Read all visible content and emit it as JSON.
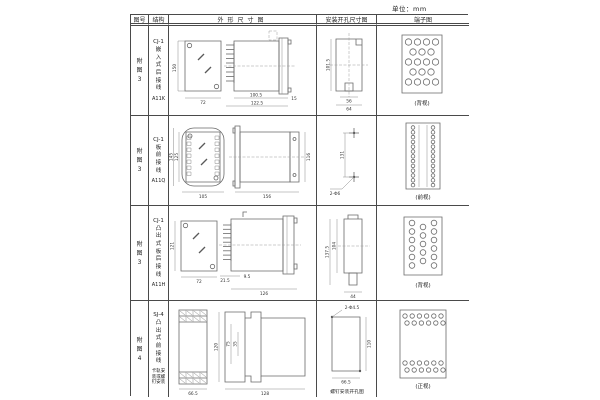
{
  "page": {
    "unit_label": "单位：mm"
  },
  "header": {
    "fig_col": "图号",
    "struct_col": "结构",
    "outline_col": "外形尺寸图",
    "mount_col": "安装开孔尺寸图",
    "terminal_col": "端子图"
  },
  "rows": [
    {
      "fig_no": "附图3",
      "model": "CJ-1",
      "structure": "嵌入式后接线",
      "code": "A11K",
      "outline": {
        "front_h": "150",
        "front_w": "72",
        "side_w1": "100.5",
        "side_w2": "122.5",
        "side_w3": "15"
      },
      "mount": {
        "v1": "101.5",
        "h1": "56",
        "h2": "64"
      },
      "terminal": {
        "view_label": "(背视)"
      }
    },
    {
      "fig_no": "附图3",
      "model": "CJ-1",
      "structure": "板前接线",
      "code": "A11Q",
      "outline": {
        "front_h1": "145",
        "front_h2": "125",
        "front_w": "105",
        "side_l": "156",
        "side_h": "116"
      },
      "mount": {
        "v1": "131",
        "hole_label": "2-Φ6"
      },
      "terminal": {
        "view_label": "(前视)"
      }
    },
    {
      "fig_no": "附图3",
      "model": "CJ-1",
      "structure": "凸出式板后接线",
      "code": "A11H",
      "outline": {
        "front_h": "121",
        "front_w": "72",
        "pin_l": "21.5",
        "gap": "9.5",
        "side_l": "126"
      },
      "mount": {
        "v1": "137.5",
        "v2": "104",
        "h1": "44"
      },
      "terminal": {
        "view_label": "(背视)"
      }
    },
    {
      "fig_no": "附图4",
      "model": "SJ-4",
      "structure": "凸出式前接线",
      "note": "卡轨安装或螺钉安装",
      "outline": {
        "front_w": "66.5",
        "side_h": "120",
        "d1": "75",
        "d2": "35",
        "side_l": "128"
      },
      "mount": {
        "hole_label": "2-Φ4.5",
        "v1": "110",
        "h1": "66.5",
        "caption": "螺钉安装开孔图"
      },
      "terminal": {
        "view_label": "(正视)"
      }
    }
  ]
}
